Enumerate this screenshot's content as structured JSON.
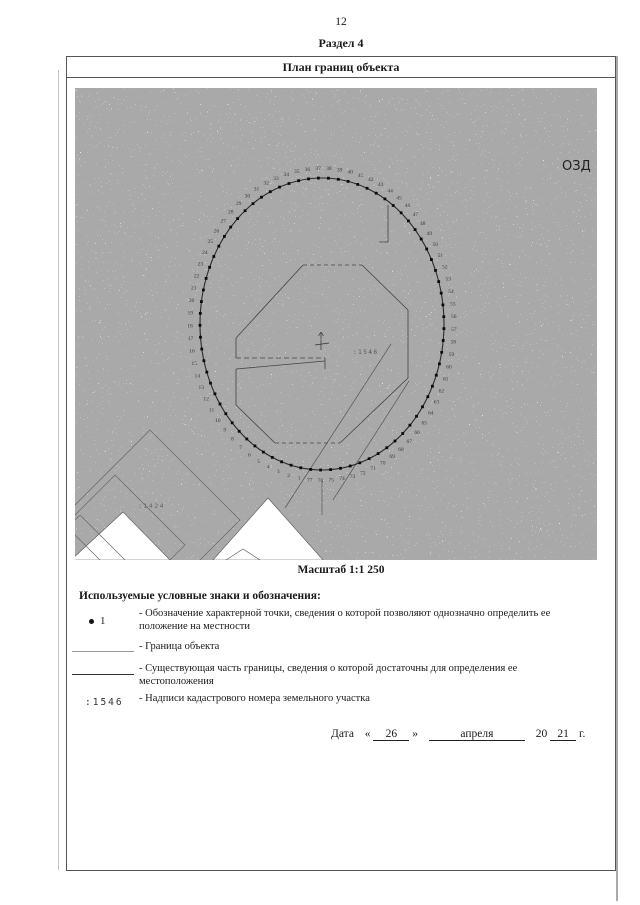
{
  "page": {
    "number": "12",
    "section": "Раздел 4"
  },
  "panel": {
    "title": "План границ объекта",
    "scale": "Масштаб 1:1 250"
  },
  "map": {
    "corner_label": "ОЗД",
    "center_cadastral": ":1546",
    "sw_cadastral": ":1424",
    "boundary_point_count": 77
  },
  "legend": {
    "heading": "Используемые условные знаки и обозначения:",
    "items": [
      {
        "symbol": "1",
        "desc": "- Обозначение характерной точки, сведения о которой позволяют однозначно определить ее положение на местности"
      },
      {
        "symbol": "",
        "desc": "- Граница объекта"
      },
      {
        "symbol": "",
        "desc": "- Существующая часть границы, сведения о которой достаточны для определения ее местоположения"
      },
      {
        "symbol": ":1546",
        "desc": "- Надписи кадастрового номера земельного участка"
      }
    ]
  },
  "date": {
    "label": "Дата",
    "lquote": "«",
    "day": "26",
    "rquote": "»",
    "month": "апреля",
    "century": "20",
    "year": "21",
    "suffix": "г."
  }
}
